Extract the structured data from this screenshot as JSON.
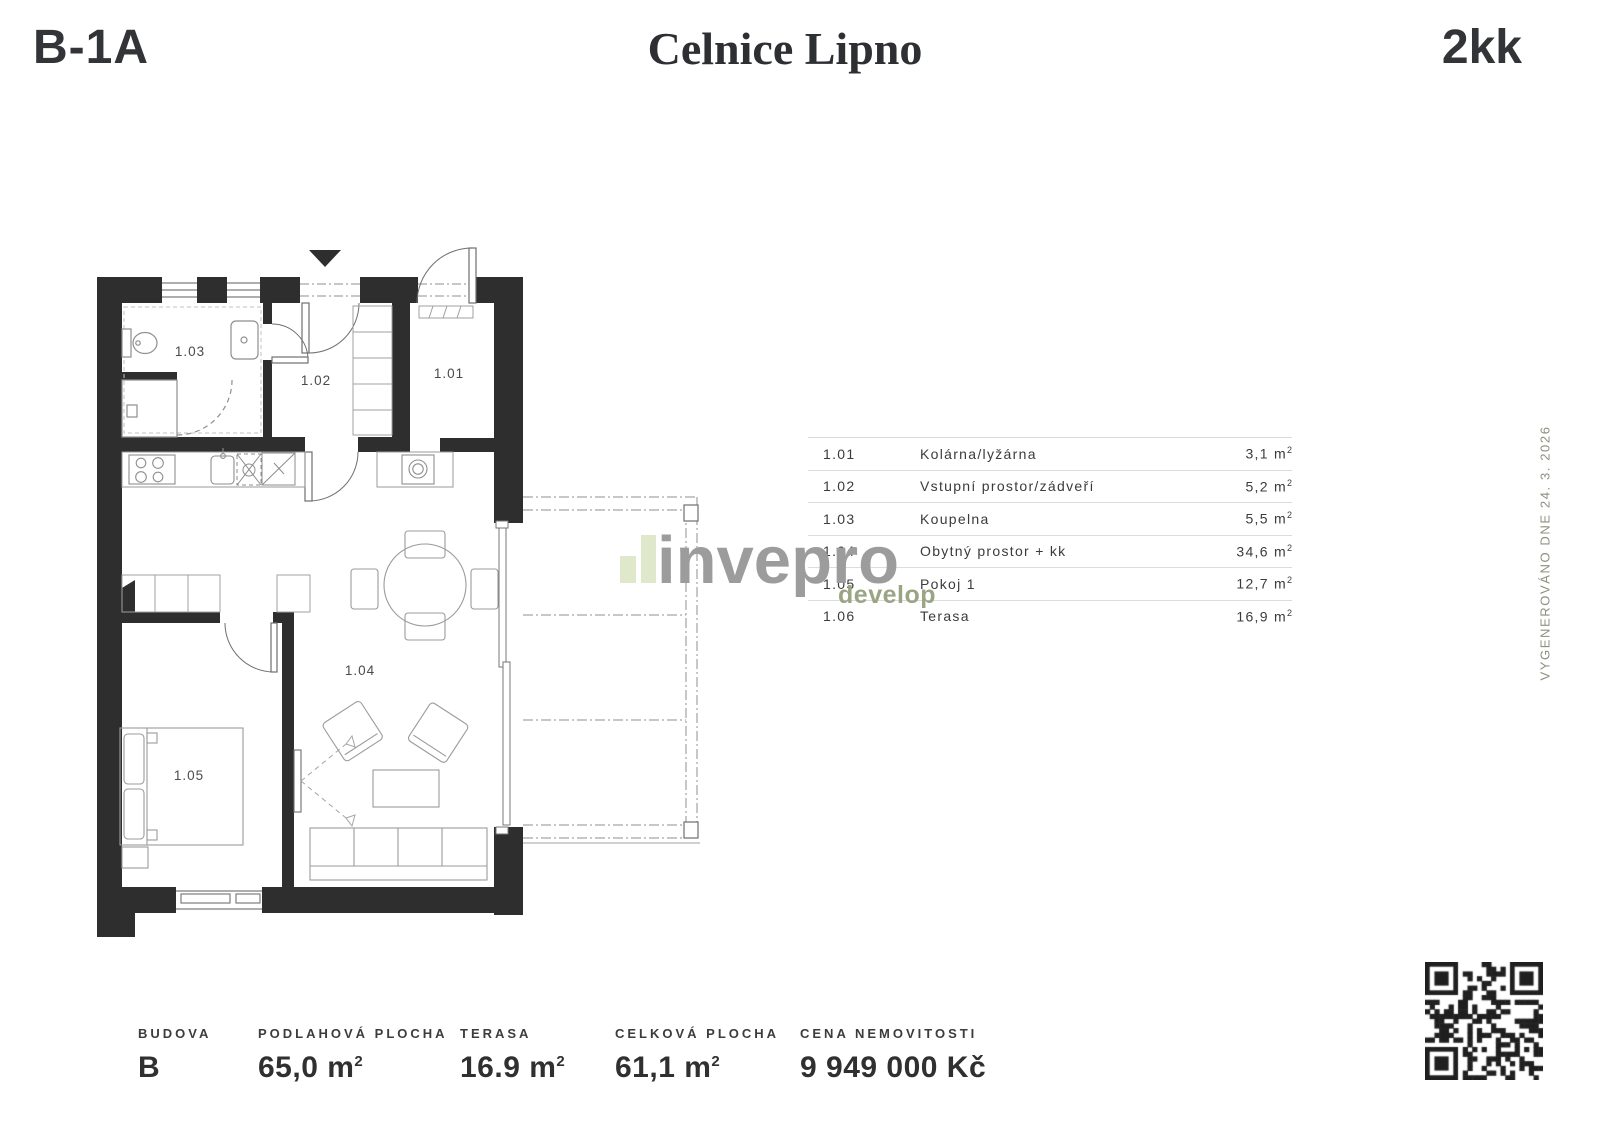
{
  "header": {
    "unit_code": "B-1A",
    "project_name": "Celnice Lipno",
    "layout_type": "2kk"
  },
  "rooms": [
    {
      "id": "1.01",
      "name": "Kolárna/lyžárna",
      "area": "3,1 m",
      "sup": "2"
    },
    {
      "id": "1.02",
      "name": "Vstupní prostor/zádveří",
      "area": "5,2 m",
      "sup": "2"
    },
    {
      "id": "1.03",
      "name": "Koupelna",
      "area": "5,5 m",
      "sup": "2"
    },
    {
      "id": "1.04",
      "name": "Obytný prostor + kk",
      "area": "34,6 m",
      "sup": "2"
    },
    {
      "id": "1.05",
      "name": "Pokoj 1",
      "area": "12,7 m",
      "sup": "2"
    },
    {
      "id": "1.06",
      "name": "Terasa",
      "area": "16,9 m",
      "sup": "2"
    }
  ],
  "watermark": {
    "brand": "invepro",
    "sub": "develop"
  },
  "generated_note": "VYGENEROVÁNO DNE 24. 3. 2026",
  "footer": {
    "items": [
      {
        "label": "BUDOVA",
        "value": "B",
        "sup": ""
      },
      {
        "label": "PODLAHOVÁ PLOCHA",
        "value": "65,0 m",
        "sup": "2"
      },
      {
        "label": "TERASA",
        "value": "16.9 m",
        "sup": "2"
      },
      {
        "label": "CELKOVÁ PLOCHA",
        "value": "61,1 m",
        "sup": "2"
      },
      {
        "label": "CENA NEMOVITOSTI",
        "value": "9 949 000 Kč",
        "sup": ""
      }
    ]
  },
  "colors": {
    "wall": "#2e2e2e",
    "furniture_line": "#999999",
    "divider": "#dcdcdc",
    "watermark_gray": "#9c9c9c",
    "watermark_green": "#9aa583",
    "logo_bar_green": "#dfe8cb",
    "note_gray_green": "#8b917e"
  }
}
